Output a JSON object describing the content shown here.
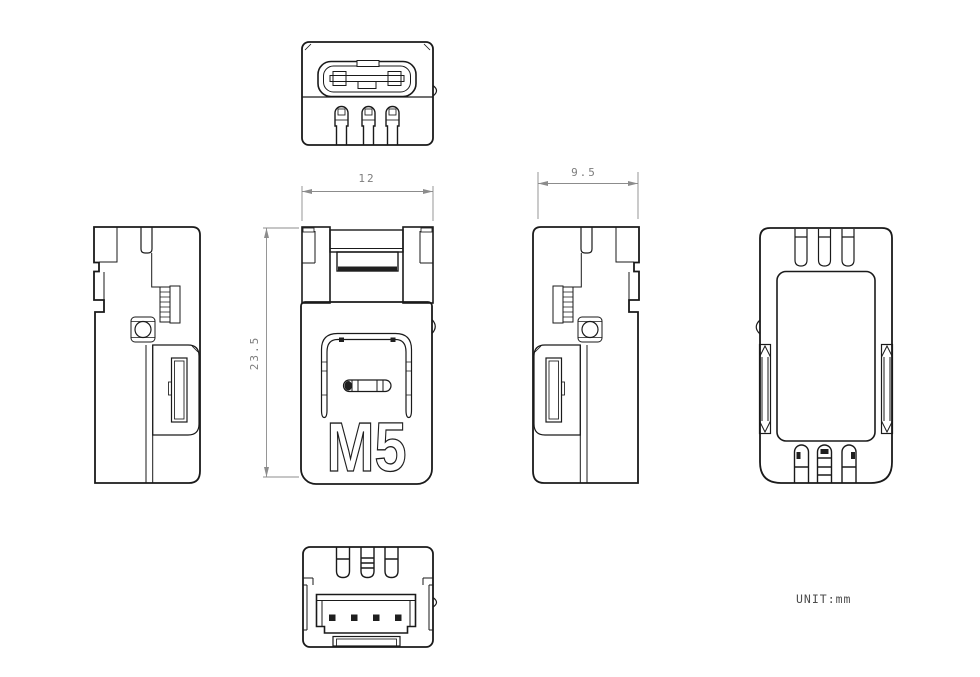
{
  "drawing": {
    "logo_text": "M5",
    "unit_note": "UNIT:mm",
    "dims": {
      "width": "12",
      "depth": "9.5",
      "height": "23.5"
    },
    "colors": {
      "line": "#1a1a1a",
      "dimension": "#8c8c8c",
      "background": "#ffffff"
    }
  }
}
